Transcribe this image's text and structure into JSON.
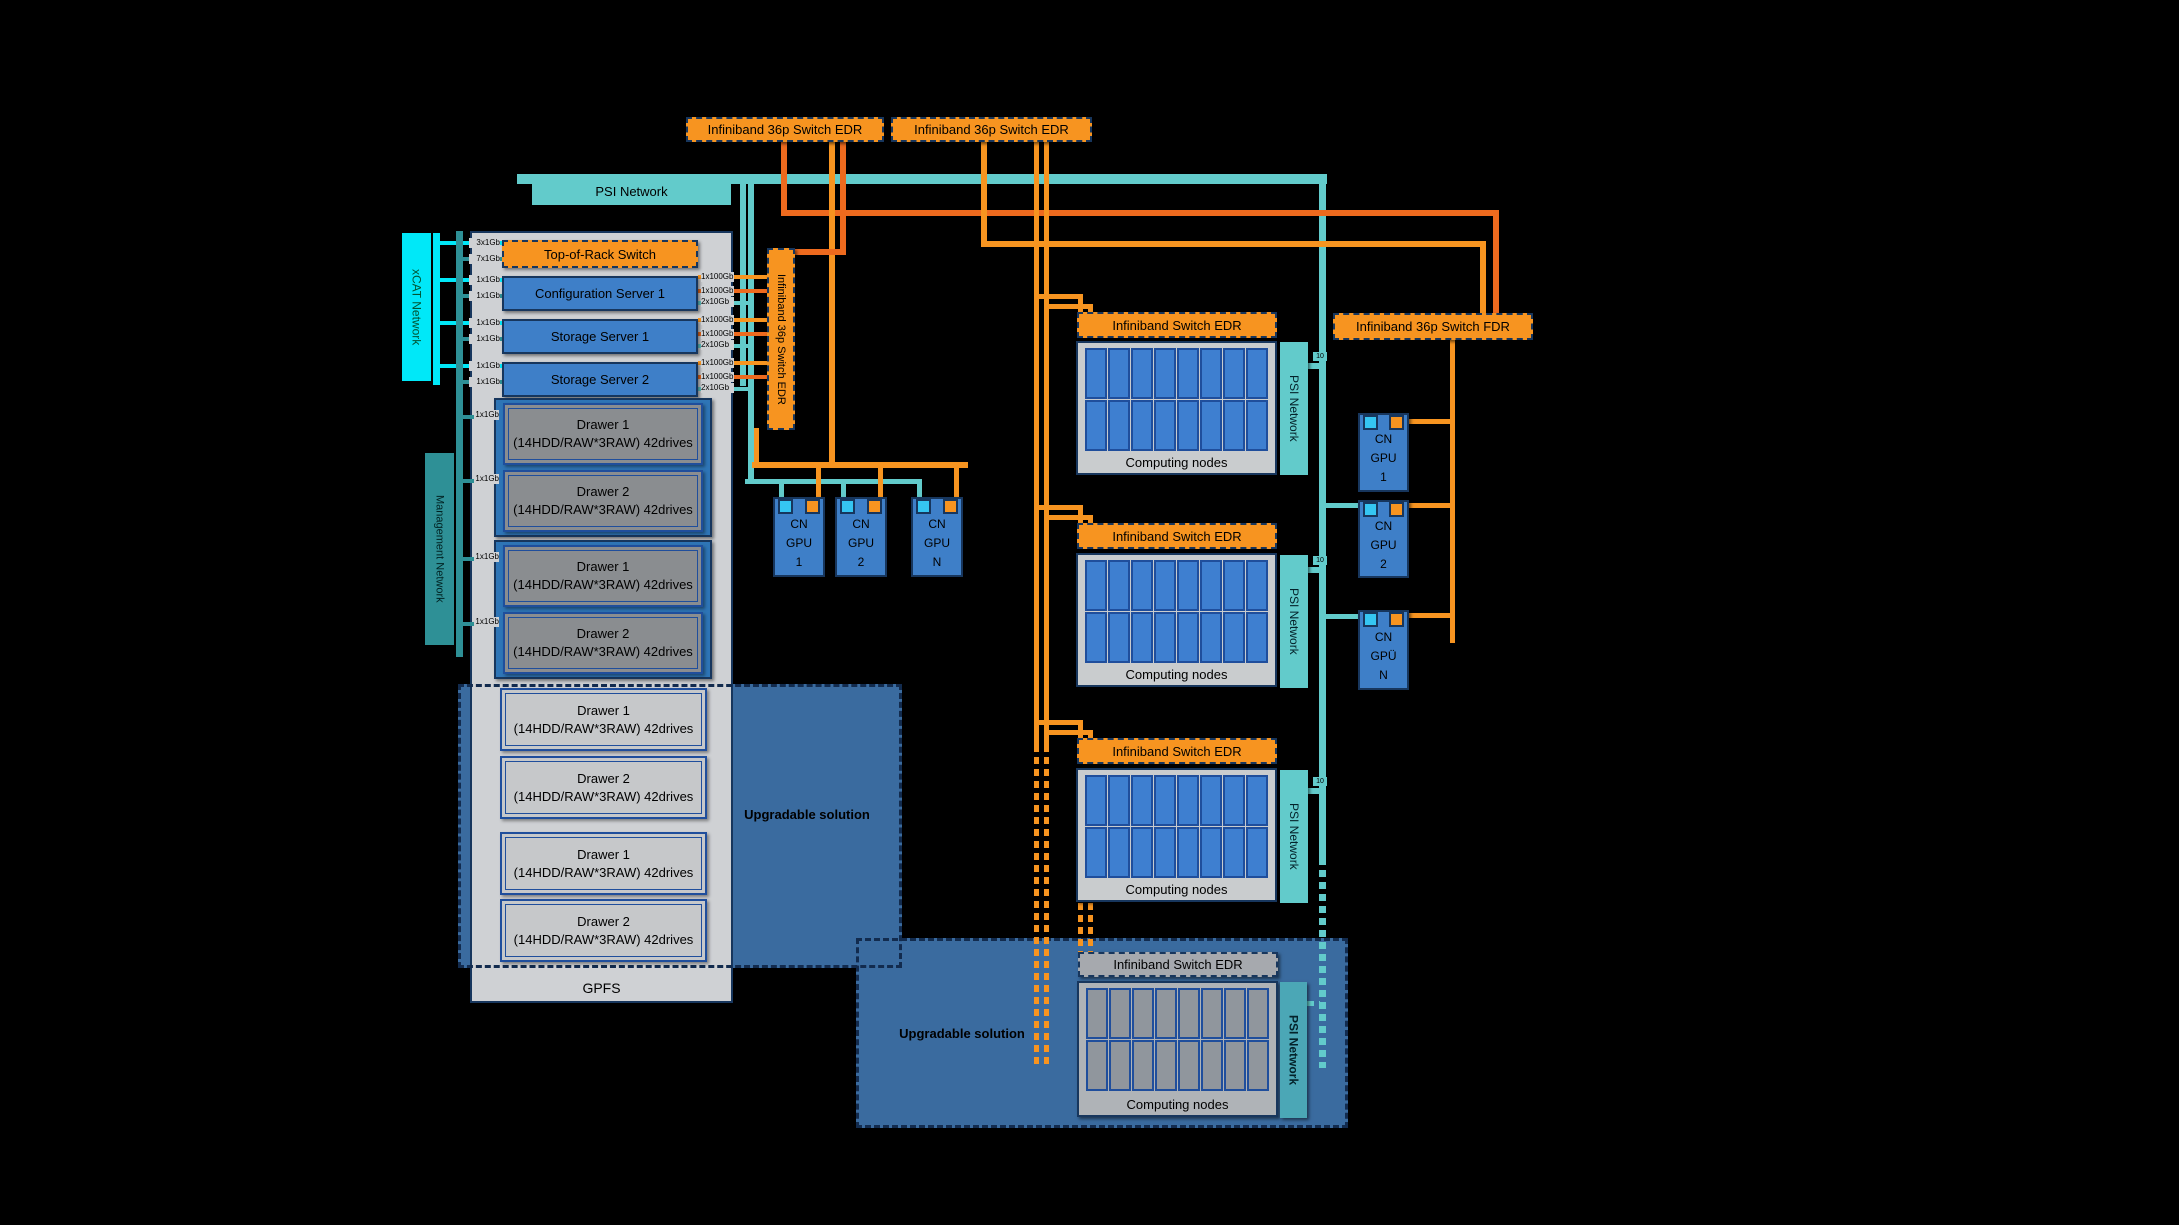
{
  "palette": {
    "orange": "#F79420",
    "orange_dark": "#EE6A1E",
    "teal": "#62CBCB",
    "teal_dark": "#2E9096",
    "cyan": "#00E8F8",
    "cyan_port": "#35C5F2",
    "navy": "#17365D",
    "blue_box": "#3E7FC8",
    "node_cell": "#3E7FD0",
    "cell_border": "#1F4E9C",
    "panel_gray": "#CFD1D4",
    "drawer_dark": "#8A8D90",
    "drawer_light": "#C6C8CA",
    "group_blue": "#2E75B6",
    "upgradable_blue": "#3A6B9F",
    "muted_header": "#A6A9AE",
    "muted_cell": "#90969D",
    "muted_container": "#AFB3B7",
    "muted_psi": "#4BA7B6"
  },
  "network_labels": {
    "psi": "PSI Network",
    "xcat": "xCAT Network",
    "management": "Management Network",
    "uplink": "10"
  },
  "switches": {
    "top": [
      "Infiniband 36p Switch EDR",
      "Infiniband 36p Switch EDR"
    ],
    "vertical": "Infiniband 36p Switch EDR",
    "fdr": "Infiniband 36p Switch FDR"
  },
  "rack": {
    "title": "GPFS",
    "devices": [
      {
        "name": "Top-of-Rack Switch",
        "kind": "switch",
        "left_ports": [
          "3x1Gb",
          "7x1Gb"
        ],
        "right_ports": []
      },
      {
        "name": "Configuration Server 1",
        "kind": "server",
        "left_ports": [
          "1x1Gb",
          "1x1Gb"
        ],
        "right_ports": [
          "1x100Gb",
          "1x100Gb",
          "2x10Gb"
        ]
      },
      {
        "name": "Storage Server 1",
        "kind": "server",
        "left_ports": [
          "1x1Gb",
          "1x1Gb"
        ],
        "right_ports": [
          "1x100Gb",
          "1x100Gb",
          "2x10Gb"
        ]
      },
      {
        "name": "Storage Server 2",
        "kind": "server",
        "left_ports": [
          "1x1Gb",
          "1x1Gb"
        ],
        "right_ports": [
          "1x100Gb",
          "1x100Gb",
          "2x10Gb"
        ]
      }
    ],
    "drawers": [
      {
        "title": "Drawer 1",
        "subtitle": "(14HDD/RAW*3RAW) 42drives",
        "port": "1x1Gb",
        "tone": "dark"
      },
      {
        "title": "Drawer 2",
        "subtitle": "(14HDD/RAW*3RAW) 42drives",
        "port": "1x1Gb",
        "tone": "dark"
      },
      {
        "title": "Drawer 1",
        "subtitle": "(14HDD/RAW*3RAW) 42drives",
        "port": "1x1Gb",
        "tone": "dark"
      },
      {
        "title": "Drawer 2",
        "subtitle": "(14HDD/RAW*3RAW) 42drives",
        "port": "1x1Gb",
        "tone": "dark"
      },
      {
        "title": "Drawer 1",
        "subtitle": "(14HDD/RAW*3RAW) 42drives",
        "port": null,
        "tone": "light"
      },
      {
        "title": "Drawer 2",
        "subtitle": "(14HDD/RAW*3RAW) 42drives",
        "port": null,
        "tone": "light"
      },
      {
        "title": "Drawer 1",
        "subtitle": "(14HDD/RAW*3RAW) 42drives",
        "port": null,
        "tone": "light"
      },
      {
        "title": "Drawer 2",
        "subtitle": "(14HDD/RAW*3RAW) 42drives",
        "port": null,
        "tone": "light"
      }
    ]
  },
  "upgradable": {
    "label_mid": "Upgradable solution",
    "label_bottom": "Upgradable solution"
  },
  "clusters": [
    {
      "switch_label": "Infiniband Switch EDR",
      "nodes_label": "Computing nodes",
      "psi_label": "PSI Network",
      "uplink_label": "10",
      "muted": false
    },
    {
      "switch_label": "Infiniband Switch EDR",
      "nodes_label": "Computing nodes",
      "psi_label": "PSI Network",
      "uplink_label": "10",
      "muted": false
    },
    {
      "switch_label": "Infiniband Switch EDR",
      "nodes_label": "Computing nodes",
      "psi_label": "PSI Network",
      "uplink_label": "10",
      "muted": false
    },
    {
      "switch_label": "Infiniband Switch EDR",
      "nodes_label": "Computing nodes",
      "psi_label": "PSI Network",
      "uplink_label": null,
      "muted": true
    }
  ],
  "gpu_nodes": {
    "left": [
      "CN GPU 1",
      "CN GPU 2",
      "CN GPU N"
    ],
    "right": [
      "CN GPU 1",
      "CN GPU 2",
      "CN GPÜ N"
    ]
  }
}
